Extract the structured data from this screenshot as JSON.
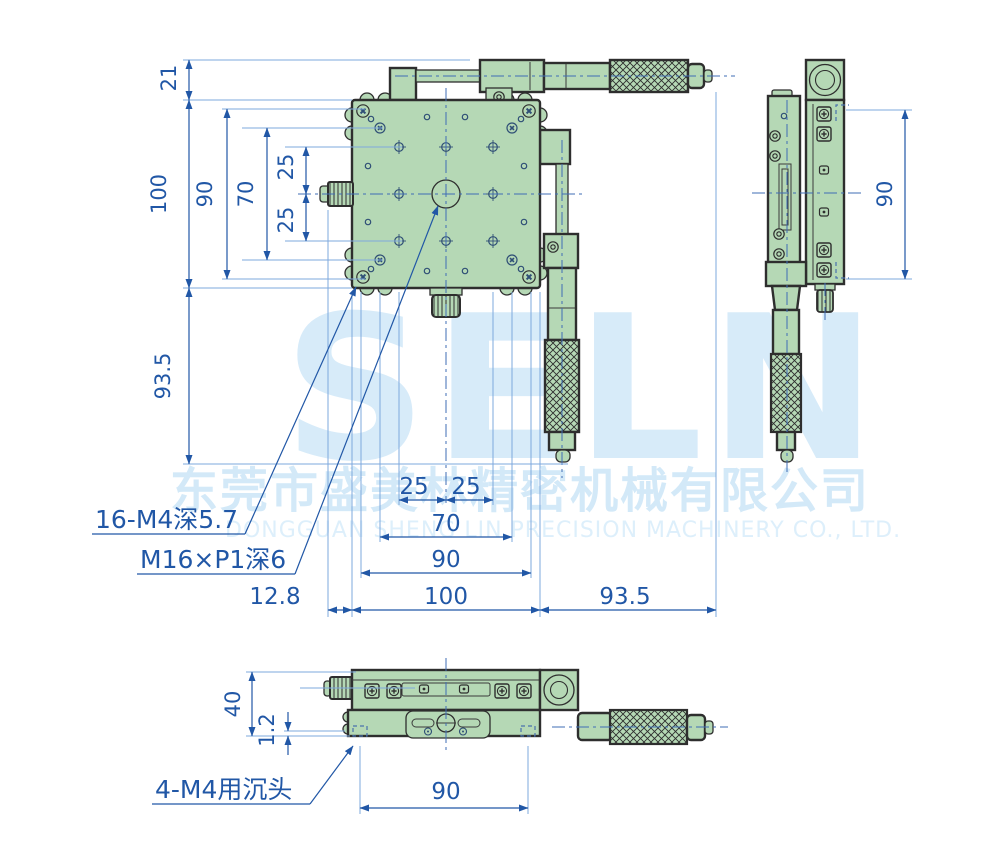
{
  "drawing_title": "XY micrometer stage dimension drawing",
  "colors": {
    "dimension_blue": "#2157a6",
    "extension_blue": "#7ea9dd",
    "centerline_blue": "#3f6db5",
    "body_fill_green": "#b5d8b5",
    "outline_dark": "#2e2e2e",
    "watermark_blue": "#d7ebf9",
    "background": "#ffffff"
  },
  "watermark": {
    "brand": "SELN",
    "company_cn": "东莞市盛美林精密机械有限公司",
    "company_en": "DONGGUAN SHENG LIN PRECISION MACHINERY CO., LTD."
  },
  "dims": {
    "left": {
      "d21": "21",
      "d100": "100",
      "d90": "90",
      "d70": "70",
      "d25a": "25",
      "d25b": "25",
      "d93_5": "93.5"
    },
    "side": {
      "d90": "90"
    },
    "bottom": {
      "d25a": "25",
      "d25b": "25",
      "d70": "70",
      "d90": "90",
      "d100": "100",
      "d12_8": "12.8",
      "d93_5": "93.5"
    },
    "front": {
      "d40": "40",
      "d1_2": "1.2",
      "d90": "90"
    }
  },
  "callouts": {
    "threaded_holes": "16-M4深5.7",
    "center_thread": "M16×P1深6",
    "counterbore": "4-M4用沉头"
  }
}
